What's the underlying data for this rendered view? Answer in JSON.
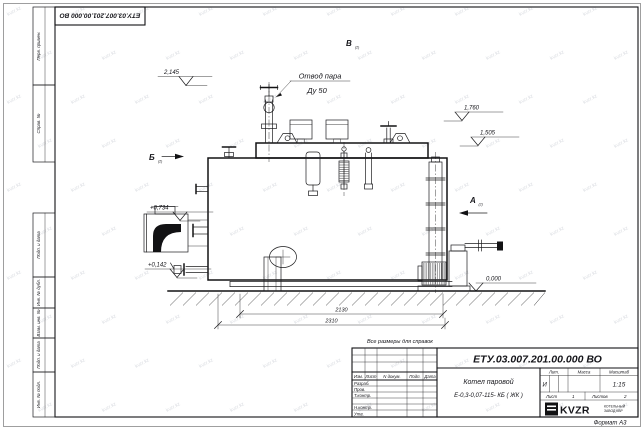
{
  "sheet": {
    "watermark": "kvzr.kz",
    "format_note": "Формат А3",
    "reference_note": "Все размеры для справок"
  },
  "stamp_top": "ЕТУ.03.007.201.00.000  ВО",
  "left_margin_fields": [
    "Перв. примен.",
    "Справ. №",
    "Подп. и дата",
    "Инв. № дубл.",
    "Взам. инв. №",
    "Подп. и дата",
    "Инв. № подл."
  ],
  "title_block": {
    "designation": "ЕТУ.03.007.201.00.000  ВО",
    "name_line1": "Котел паровой",
    "name_line2": "Е-0,3-0,07-115- КБ ( ЖК )",
    "header_cells": [
      "Изм.",
      "Лист",
      "N докум.",
      "Подп.",
      "Дата"
    ],
    "sign_rows": [
      "Разраб.",
      "Пров.",
      "Т.контр.",
      "",
      "Н.контр.",
      "Утв."
    ],
    "lit_label": "Лит.",
    "lit_value": "И",
    "mass_label": "Масса",
    "mass_value": "",
    "scale_label": "Масштаб",
    "scale_value": "1:15",
    "sheet_label": "Лист",
    "sheet_num": "1",
    "sheets_label": "Листов",
    "sheets_num": "2",
    "logo_text": "KVZR",
    "logo_sub1": "КОТЕЛЬНЫЙ",
    "logo_sub2": "ЗАВОД КВР"
  },
  "annotations": {
    "callout_line1": "Отвод пара",
    "callout_line2": "Ду 50",
    "view_a": "А",
    "view_b": "Б",
    "view_v": "В",
    "view_ref": "(2)",
    "elev_2145": "2,145",
    "elev_1760": "1,760",
    "elev_1505": "1,505",
    "elev_0734": "+0,734",
    "elev_0142": "+0,142",
    "elev_0000": "0,000",
    "dim_2130": "2130",
    "dim_2310": "2310"
  }
}
